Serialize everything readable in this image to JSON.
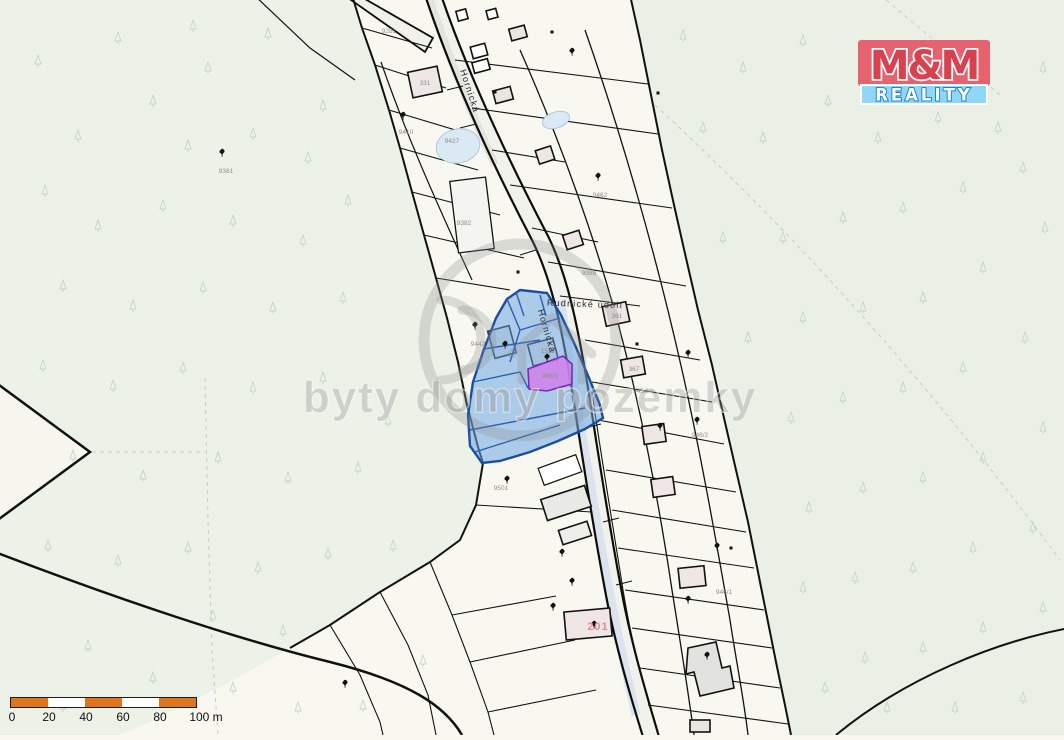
{
  "branding": {
    "logo_line1": "M&M",
    "logo_line2": "REALITY",
    "colors": {
      "logo_top_bg": "#e4636e",
      "logo_top_text": "#d8414f",
      "logo_bottom_bg": "#90d7f5",
      "logo_bottom_outline": "#1f85c9"
    }
  },
  "watermark": {
    "text": "byty domy pozemky"
  },
  "scalebar": {
    "labels": [
      "0",
      "20",
      "40",
      "60",
      "80",
      "100 m"
    ],
    "segment_color": "#e0751e"
  },
  "map": {
    "highlight_colors": {
      "selected_parcel_fill": "#79aee0",
      "selected_parcel_border": "#1d4e9e",
      "secondary_parcel_fill": "#cf80ea",
      "secondary_parcel_border": "#7a2bb5"
    },
    "street_labels": [
      {
        "text": "Hornická",
        "x": 467,
        "y": 92,
        "rot": 72
      },
      {
        "text": "Hornická",
        "x": 544,
        "y": 332,
        "rot": 74
      },
      {
        "text": "Rudnické údolí",
        "x": 585,
        "y": 307,
        "rot": 2
      }
    ],
    "parcel_labels": [
      {
        "text": "9281",
        "x": 389,
        "y": 33
      },
      {
        "text": "9410",
        "x": 406,
        "y": 134
      },
      {
        "text": "9427",
        "x": 452,
        "y": 143
      },
      {
        "text": "9381",
        "x": 226,
        "y": 173
      },
      {
        "text": "9382",
        "x": 464,
        "y": 225
      },
      {
        "text": "9442",
        "x": 478,
        "y": 346
      },
      {
        "text": "9462",
        "x": 600,
        "y": 197
      },
      {
        "text": "9388",
        "x": 589,
        "y": 275
      },
      {
        "text": "1512",
        "x": 548,
        "y": 353
      },
      {
        "text": "945/1",
        "x": 550,
        "y": 378
      },
      {
        "text": "331",
        "x": 425,
        "y": 85
      },
      {
        "text": "361",
        "x": 617,
        "y": 318
      },
      {
        "text": "367",
        "x": 634,
        "y": 371
      },
      {
        "text": "945/10",
        "x": 643,
        "y": 393
      },
      {
        "text": "946/2",
        "x": 700,
        "y": 437
      },
      {
        "text": "946/1",
        "x": 724,
        "y": 594
      },
      {
        "text": "9501",
        "x": 501,
        "y": 490
      },
      {
        "text": "201",
        "x": 598,
        "y": 630,
        "cls": "big"
      }
    ],
    "tree_symbols": [
      [
        222,
        157
      ],
      [
        403,
        120
      ],
      [
        572,
        56
      ],
      [
        598,
        181
      ],
      [
        475,
        330
      ],
      [
        505,
        349
      ],
      [
        547,
        362
      ],
      [
        688,
        358
      ],
      [
        697,
        425
      ],
      [
        660,
        431
      ],
      [
        717,
        551
      ],
      [
        688,
        604
      ],
      [
        553,
        611
      ],
      [
        594,
        629
      ],
      [
        507,
        484
      ],
      [
        562,
        557
      ],
      [
        572,
        586
      ],
      [
        707,
        660
      ],
      [
        345,
        688
      ]
    ],
    "survey_marks": [
      [
        552,
        32
      ],
      [
        495,
        92
      ],
      [
        518,
        272
      ],
      [
        658,
        93
      ],
      [
        731,
        548
      ],
      [
        637,
        344
      ]
    ],
    "forest_marks": [
      [
        35,
        55
      ],
      [
        115,
        32
      ],
      [
        190,
        20
      ],
      [
        265,
        28
      ],
      [
        75,
        130
      ],
      [
        42,
        185
      ],
      [
        150,
        95
      ],
      [
        205,
        62
      ],
      [
        320,
        100
      ],
      [
        185,
        140
      ],
      [
        250,
        128
      ],
      [
        305,
        152
      ],
      [
        95,
        220
      ],
      [
        160,
        200
      ],
      [
        230,
        215
      ],
      [
        300,
        235
      ],
      [
        345,
        195
      ],
      [
        60,
        280
      ],
      [
        130,
        300
      ],
      [
        200,
        282
      ],
      [
        270,
        302
      ],
      [
        340,
        292
      ],
      [
        40,
        360
      ],
      [
        110,
        380
      ],
      [
        180,
        362
      ],
      [
        250,
        382
      ],
      [
        320,
        372
      ],
      [
        385,
        415
      ],
      [
        70,
        450
      ],
      [
        140,
        470
      ],
      [
        215,
        452
      ],
      [
        285,
        472
      ],
      [
        355,
        462
      ],
      [
        45,
        540
      ],
      [
        115,
        555
      ],
      [
        185,
        542
      ],
      [
        255,
        562
      ],
      [
        325,
        548
      ],
      [
        390,
        540
      ],
      [
        85,
        640
      ],
      [
        150,
        672
      ],
      [
        230,
        682
      ],
      [
        60,
        700
      ],
      [
        295,
        702
      ],
      [
        360,
        700
      ],
      [
        420,
        655
      ],
      [
        210,
        610
      ],
      [
        280,
        625
      ],
      [
        680,
        30
      ],
      [
        740,
        62
      ],
      [
        800,
        35
      ],
      [
        825,
        95
      ],
      [
        760,
        132
      ],
      [
        700,
        122
      ],
      [
        875,
        132
      ],
      [
        935,
        112
      ],
      [
        995,
        122
      ],
      [
        1040,
        62
      ],
      [
        1020,
        162
      ],
      [
        960,
        182
      ],
      [
        900,
        202
      ],
      [
        840,
        212
      ],
      [
        780,
        232
      ],
      [
        720,
        232
      ],
      [
        1042,
        222
      ],
      [
        980,
        262
      ],
      [
        920,
        292
      ],
      [
        860,
        302
      ],
      [
        800,
        312
      ],
      [
        745,
        332
      ],
      [
        1022,
        332
      ],
      [
        960,
        362
      ],
      [
        900,
        382
      ],
      [
        840,
        392
      ],
      [
        788,
        412
      ],
      [
        1040,
        422
      ],
      [
        980,
        452
      ],
      [
        920,
        472
      ],
      [
        860,
        482
      ],
      [
        806,
        502
      ],
      [
        1030,
        522
      ],
      [
        970,
        542
      ],
      [
        910,
        562
      ],
      [
        852,
        572
      ],
      [
        800,
        582
      ],
      [
        1040,
        602
      ],
      [
        980,
        622
      ],
      [
        920,
        642
      ],
      [
        862,
        652
      ],
      [
        1020,
        692
      ],
      [
        952,
        702
      ],
      [
        884,
        702
      ],
      [
        822,
        682
      ]
    ]
  }
}
